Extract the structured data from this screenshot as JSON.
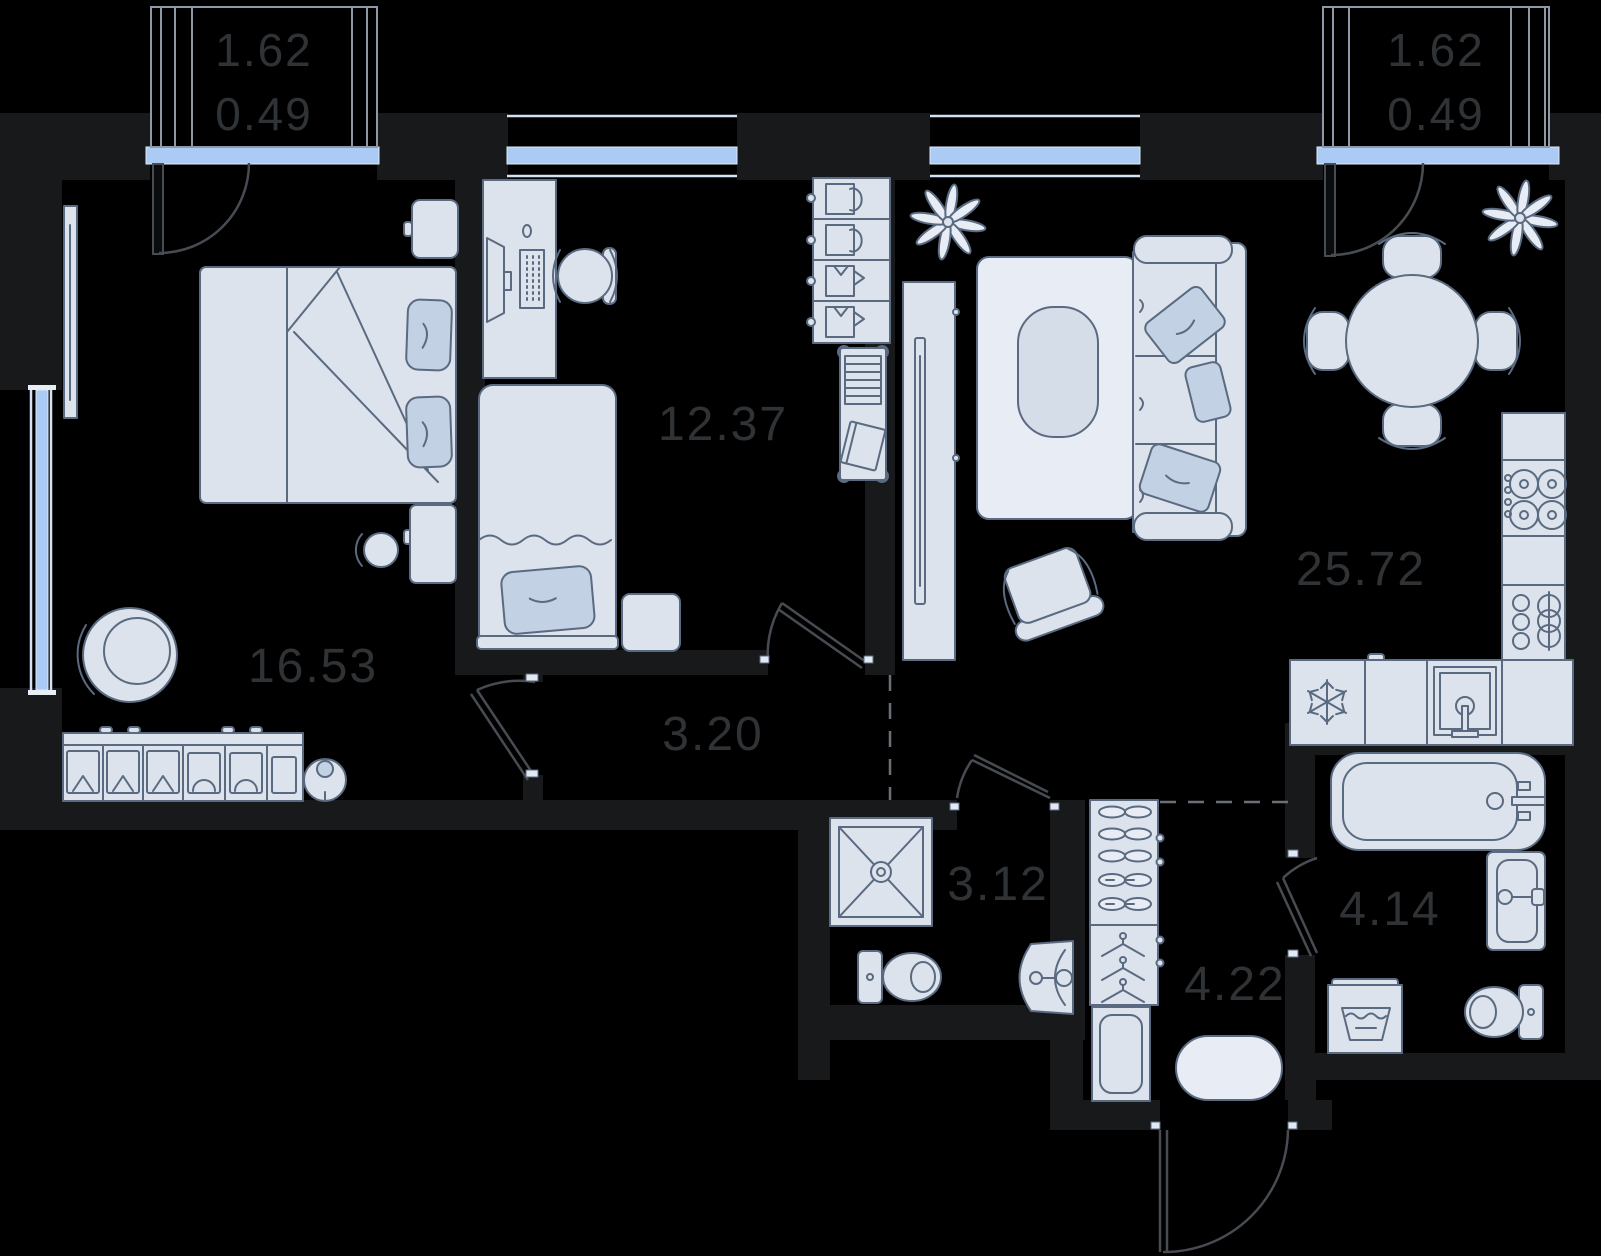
{
  "document": {
    "type": "apartment-floor-plan"
  },
  "rooms": {
    "bedroom": {
      "label": "16.53"
    },
    "office": {
      "label": "12.37"
    },
    "hallway": {
      "label": "3.20"
    },
    "living_kitchen": {
      "label": "25.72"
    },
    "shower_room": {
      "label": "3.12"
    },
    "closet": {
      "label": "4.22"
    },
    "bathroom": {
      "label": "4.14"
    }
  },
  "balconies": {
    "left": {
      "area": "1.62",
      "reduced": "0.49"
    },
    "right": {
      "area": "1.62",
      "reduced": "0.49"
    }
  },
  "furniture": {
    "bedroom": [
      "double-bed",
      "pillows",
      "nightstand",
      "vanity-table",
      "stool",
      "armchair",
      "wardrobe",
      "robot-vacuum",
      "tv"
    ],
    "office": [
      "desk",
      "monitor",
      "keyboard",
      "office-chair",
      "single-bed",
      "nightstand",
      "wardrobe",
      "book-trolley"
    ],
    "living_kitchen": [
      "sofa",
      "pillows",
      "rug",
      "coffee-table",
      "armchair",
      "tv-stand",
      "plant",
      "dining-table",
      "chairs",
      "stove",
      "fridge",
      "kitchen-sink",
      "counter"
    ],
    "shower_room": [
      "shower-tray",
      "toilet",
      "corner-sink"
    ],
    "closet": [
      "shoe-wardrobe",
      "hangers",
      "cabinet",
      "oval-rug"
    ],
    "bathroom": [
      "bathtub",
      "sink",
      "washing-machine",
      "toilet"
    ]
  },
  "colors": {
    "background": "#000000",
    "wall": "#18191b",
    "furniture_fill": "#dce3ed",
    "furniture_stroke": "#5a6a80",
    "accent_fill": "#c2d1e3",
    "window_glass": "#abcbf5",
    "label_text": "#303336"
  }
}
